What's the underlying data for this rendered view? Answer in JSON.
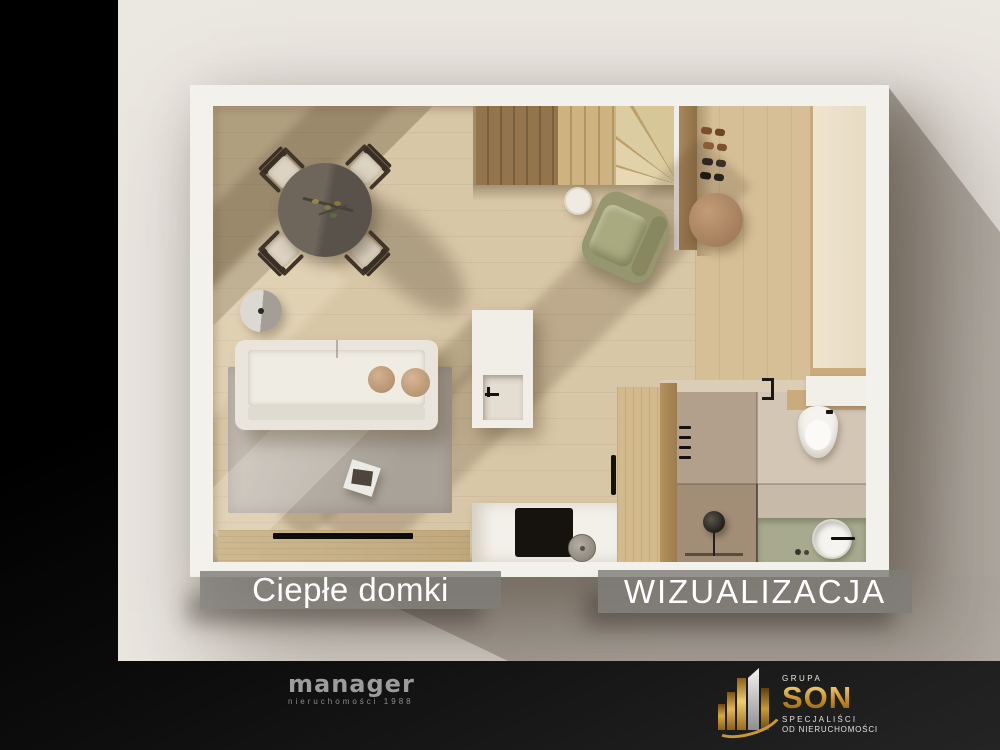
{
  "watermark": {
    "project_label": "Ciepłe domki",
    "type_label": "WIZUALIZACJA"
  },
  "footer": {
    "manager": {
      "name": "manager",
      "tagline": "nieruchomości 1988"
    },
    "son": {
      "group": "GRUPA",
      "name": "SON",
      "subtitle_line1": "SPECJALIŚCI",
      "subtitle_line2": "OD NIERUCHOMOŚCI"
    }
  },
  "icons": {
    "son_emblem": "gold-skyline-swoosh-icon"
  },
  "colors": {
    "canvas_black": "#000000",
    "backdrop_cream": "#ebe7e1",
    "shadow_taupe": "#b0a9a1",
    "label_bar_gray": "rgba(127,124,119,0.82)",
    "label_text": "#ffffff",
    "floor_oak": "#d8c7a6",
    "entry_oak": "#d6bf97",
    "manager_gray": "#9c9c9c",
    "son_gold": "#d7a93c",
    "vanity_sage": "#a7aa8e",
    "armchair_olive": "#96976e"
  }
}
